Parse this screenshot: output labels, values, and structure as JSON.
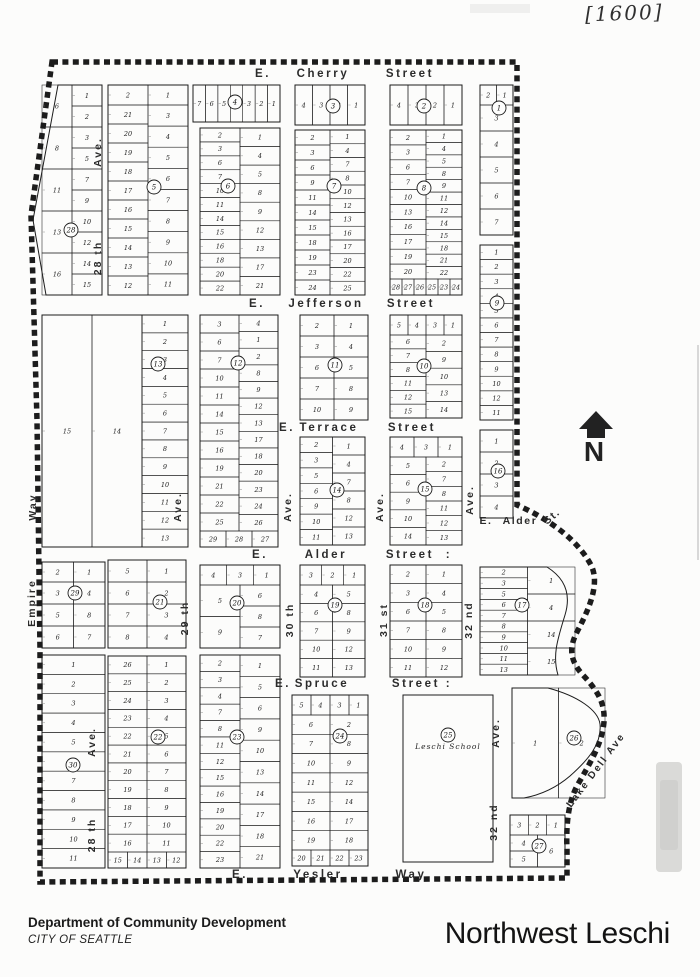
{
  "page": {
    "annotation": "[1600]",
    "title": "Northwest Leschi",
    "footer_line1": "Department of Community Development",
    "footer_line2": "CITY OF SEATTLE"
  },
  "map": {
    "north_label": "N",
    "streets": [
      {
        "name": "E. Cherry Street",
        "y": 77,
        "parts": [
          {
            "t": "E.",
            "x": 263
          },
          {
            "t": "Cherry",
            "x": 323
          },
          {
            "t": "Street",
            "x": 410
          }
        ]
      },
      {
        "name": "E. Jefferson Street",
        "y": 307,
        "parts": [
          {
            "t": "E.",
            "x": 257
          },
          {
            "t": "Jefferson",
            "x": 326
          },
          {
            "t": "Street",
            "x": 411
          }
        ]
      },
      {
        "name": "E. Terrace Street",
        "y": 431,
        "parts": [
          {
            "t": "E.",
            "x": 287
          },
          {
            "t": "Terrace",
            "x": 329
          },
          {
            "t": "Street",
            "x": 412
          }
        ]
      },
      {
        "name": "E. Alder Street",
        "y": 558,
        "parts": [
          {
            "t": "E.",
            "x": 260
          },
          {
            "t": "Alder",
            "x": 326
          },
          {
            "t": "Street",
            "x": 410
          },
          {
            "t": ":",
            "x": 449
          }
        ]
      },
      {
        "name": "E. Spruce Street",
        "y": 687,
        "parts": [
          {
            "t": "E.",
            "x": 283
          },
          {
            "t": "Spruce",
            "x": 322
          },
          {
            "t": "Street",
            "x": 416
          },
          {
            "t": ":",
            "x": 449
          }
        ]
      },
      {
        "name": "E. Yesler Way",
        "y": 878,
        "parts": [
          {
            "t": "E.",
            "x": 240
          },
          {
            "t": "Yesler",
            "x": 318
          },
          {
            "t": "Way",
            "x": 411
          }
        ]
      }
    ],
    "avenues": [
      {
        "t": "Ave.",
        "x": 101,
        "y": 152
      },
      {
        "t": "28 th",
        "x": 101,
        "y": 258
      },
      {
        "t": "Way",
        "x": 36,
        "y": 507
      },
      {
        "t": "Empire",
        "x": 35,
        "y": 603
      },
      {
        "t": "Ave.",
        "x": 181,
        "y": 507
      },
      {
        "t": "29 th",
        "x": 188,
        "y": 618
      },
      {
        "t": "Ave.",
        "x": 291,
        "y": 507
      },
      {
        "t": "30 th",
        "x": 293,
        "y": 620
      },
      {
        "t": "Ave.",
        "x": 383,
        "y": 507
      },
      {
        "t": "31 st",
        "x": 387,
        "y": 620
      },
      {
        "t": "Ave.",
        "x": 473,
        "y": 500
      },
      {
        "t": "32 nd",
        "x": 472,
        "y": 620
      },
      {
        "t": "Ave.",
        "x": 499,
        "y": 733
      },
      {
        "t": "32 nd",
        "x": 497,
        "y": 822
      },
      {
        "t": "Ave.",
        "x": 95,
        "y": 742
      },
      {
        "t": "28 th",
        "x": 95,
        "y": 835
      }
    ],
    "labels": {
      "alder_st": [
        {
          "t": "E.",
          "x": 486,
          "y": 524,
          "r": 0
        },
        {
          "t": "Alder",
          "x": 520,
          "y": 524,
          "r": 0
        },
        {
          "t": "St.",
          "x": 554,
          "y": 519,
          "r": -40
        }
      ],
      "lake": {
        "t": "Lake  Dell  Ave",
        "x": 571,
        "y": 808,
        "r": -53
      },
      "school": "Leschi School"
    },
    "blocks": [
      {
        "n": "1",
        "x": 480,
        "y": 85,
        "w": 33,
        "h": 150,
        "c": [
          499,
          108
        ],
        "t": [
          "2",
          "1"
        ],
        "cols": [
          [
            "3",
            "4",
            "5",
            "6",
            "7"
          ]
        ]
      },
      {
        "n": "2",
        "x": 390,
        "y": 85,
        "w": 72,
        "h": 40,
        "c": [
          424,
          106
        ],
        "t": [
          "4",
          "3",
          "2",
          "1"
        ]
      },
      {
        "n": "3",
        "x": 295,
        "y": 85,
        "w": 70,
        "h": 40,
        "c": [
          333,
          106
        ],
        "t": [
          "4",
          "3",
          "2",
          "1"
        ]
      },
      {
        "n": "4",
        "x": 193,
        "y": 85,
        "w": 87,
        "h": 37,
        "c": [
          235,
          102
        ],
        "t": [
          "7",
          "6",
          "5",
          "4",
          "3",
          "2",
          "1"
        ]
      },
      {
        "n": "5",
        "x": 108,
        "y": 85,
        "w": 80,
        "h": 210,
        "c": [
          154,
          187
        ],
        "t": [
          "2",
          "1"
        ],
        "cols": [
          [
            "21",
            "20",
            "19",
            "18",
            "17",
            "16",
            "15",
            "14",
            "13",
            "12"
          ],
          [
            "3",
            "4",
            "5",
            "6",
            "7",
            "8",
            "9",
            "10",
            "11"
          ]
        ]
      },
      {
        "n": "6",
        "x": 200,
        "y": 128,
        "w": 80,
        "h": 167,
        "c": [
          228,
          186
        ],
        "cols": [
          [
            "2",
            "3",
            "6",
            "7",
            "10",
            "11",
            "14",
            "15",
            "16",
            "18",
            "20",
            "22"
          ],
          [
            "1",
            "4",
            "5",
            "8",
            "9",
            "12",
            "13",
            "17",
            "21"
          ]
        ]
      },
      {
        "n": "7",
        "x": 295,
        "y": 130,
        "w": 70,
        "h": 165,
        "c": [
          334,
          186
        ],
        "cols": [
          [
            "2",
            "3",
            "6",
            "9",
            "11",
            "14",
            "15",
            "18",
            "19",
            "23",
            "24"
          ],
          [
            "1",
            "4",
            "7",
            "8",
            "10",
            "12",
            "13",
            "16",
            "17",
            "20",
            "22",
            "25"
          ]
        ]
      },
      {
        "n": "8",
        "x": 390,
        "y": 130,
        "w": 72,
        "h": 165,
        "c": [
          424,
          188
        ],
        "cols": [
          [
            "2",
            "3",
            "6",
            "7",
            "10",
            "13",
            "16",
            "17",
            "19",
            "20"
          ],
          [
            "1",
            "4",
            "5",
            "8",
            "9",
            "11",
            "12",
            "14",
            "15",
            "18",
            "21",
            "22"
          ]
        ],
        "b": [
          "28",
          "27",
          "26",
          "25",
          "23",
          "24"
        ]
      },
      {
        "n": "9",
        "x": 480,
        "y": 245,
        "w": 33,
        "h": 175,
        "c": [
          497,
          303
        ],
        "cols": [
          [
            "1",
            "2",
            "3",
            "4",
            "5",
            "6",
            "7",
            "8",
            "9",
            "10",
            "12",
            "11"
          ]
        ]
      },
      {
        "n": "10",
        "x": 390,
        "y": 315,
        "w": 72,
        "h": 103,
        "c": [
          424,
          366
        ],
        "t": [
          "5",
          "4",
          "3",
          "1"
        ],
        "cols": [
          [
            "6",
            "7",
            "8",
            "11",
            "12",
            "15"
          ],
          [
            "2",
            "9",
            "10",
            "13",
            "14"
          ]
        ]
      },
      {
        "n": "11",
        "x": 300,
        "y": 315,
        "w": 68,
        "h": 105,
        "c": [
          335,
          365
        ],
        "cols": [
          [
            "2",
            "3",
            "6",
            "7",
            "10"
          ],
          [
            "1",
            "4",
            "5",
            "8",
            "9"
          ]
        ]
      },
      {
        "n": "12",
        "x": 200,
        "y": 315,
        "w": 78,
        "h": 232,
        "c": [
          238,
          363
        ],
        "cols": [
          [
            "3",
            "6",
            "7",
            "10",
            "11",
            "14",
            "15",
            "16",
            "19",
            "21",
            "22",
            "25"
          ],
          [
            "4",
            "1",
            "2",
            "8",
            "9",
            "12",
            "13",
            "17",
            "18",
            "20",
            "23",
            "24",
            "26"
          ]
        ],
        "b": [
          "29",
          "28",
          "27"
        ]
      },
      {
        "n": "13",
        "x": 142,
        "y": 315,
        "w": 46,
        "h": 232,
        "c": [
          158,
          364
        ],
        "cols": [
          [
            "1",
            "2",
            "3",
            "4",
            "5",
            "6",
            "7",
            "8",
            "9",
            "10",
            "11",
            "12",
            "13"
          ]
        ]
      },
      {
        "n": "",
        "x": 42,
        "y": 315,
        "w": 100,
        "h": 232,
        "cols": [
          [
            "15"
          ],
          [
            "14"
          ]
        ]
      },
      {
        "n": "14",
        "x": 300,
        "y": 437,
        "w": 65,
        "h": 108,
        "c": [
          337,
          490
        ],
        "cols": [
          [
            "2",
            "3",
            "5",
            "6",
            "9",
            "10",
            "11"
          ],
          [
            "1",
            "4",
            "7",
            "8",
            "12",
            "13"
          ]
        ]
      },
      {
        "n": "15",
        "x": 390,
        "y": 437,
        "w": 72,
        "h": 108,
        "c": [
          425,
          489
        ],
        "t": [
          "4",
          "3",
          "1"
        ],
        "cols": [
          [
            "5",
            "6",
            "9",
            "10",
            "14"
          ],
          [
            "2",
            "7",
            "8",
            "11",
            "12",
            "13"
          ]
        ]
      },
      {
        "n": "16",
        "x": 480,
        "y": 430,
        "w": 33,
        "h": 88,
        "c": [
          498,
          471
        ],
        "cols": [
          [
            "1",
            "2",
            "3",
            "4"
          ]
        ]
      },
      {
        "n": "17",
        "x": 480,
        "y": 567,
        "w": 95,
        "h": 108,
        "c": [
          522,
          605
        ],
        "cols": [
          [
            "2",
            "3",
            "5",
            "6",
            "7",
            "8",
            "9",
            "10",
            "11",
            "13"
          ],
          [
            "1",
            "4",
            "14",
            "15"
          ]
        ],
        "curve": "e17"
      },
      {
        "n": "18",
        "x": 390,
        "y": 565,
        "w": 72,
        "h": 112,
        "c": [
          425,
          605
        ],
        "cols": [
          [
            "2",
            "3",
            "6",
            "7",
            "10",
            "11"
          ],
          [
            "1",
            "4",
            "5",
            "8",
            "9",
            "12"
          ]
        ]
      },
      {
        "n": "19",
        "x": 300,
        "y": 565,
        "w": 65,
        "h": 112,
        "c": [
          335,
          605
        ],
        "t": [
          "3",
          "2",
          "1"
        ],
        "cols": [
          [
            "4",
            "6",
            "7",
            "10",
            "11"
          ],
          [
            "5",
            "8",
            "9",
            "12",
            "13"
          ]
        ]
      },
      {
        "n": "20",
        "x": 200,
        "y": 565,
        "w": 80,
        "h": 83,
        "c": [
          237,
          603
        ],
        "t": [
          "4",
          "3",
          "1"
        ],
        "cols": [
          [
            "5",
            "9"
          ],
          [
            "6",
            "8",
            "7"
          ]
        ]
      },
      {
        "n": "21",
        "x": 108,
        "y": 560,
        "w": 78,
        "h": 88,
        "c": [
          160,
          602
        ],
        "cols": [
          [
            "5",
            "6",
            "7",
            "8"
          ],
          [
            "1",
            "2",
            "3",
            "4"
          ]
        ]
      },
      {
        "n": "22",
        "x": 108,
        "y": 656,
        "w": 78,
        "h": 212,
        "c": [
          158,
          737
        ],
        "cols": [
          [
            "26",
            "25",
            "24",
            "23",
            "22",
            "21",
            "20",
            "19",
            "18",
            "17",
            "16"
          ],
          [
            "1",
            "2",
            "3",
            "4",
            "5",
            "6",
            "7",
            "8",
            "9",
            "10",
            "11"
          ]
        ],
        "b": [
          "15",
          "14",
          "13",
          "12"
        ]
      },
      {
        "n": "23",
        "x": 200,
        "y": 655,
        "w": 80,
        "h": 213,
        "c": [
          237,
          737
        ],
        "cols": [
          [
            "2",
            "3",
            "4",
            "7",
            "8",
            "11",
            "12",
            "15",
            "16",
            "19",
            "20",
            "22",
            "23"
          ],
          [
            "1",
            "5",
            "6",
            "9",
            "10",
            "13",
            "14",
            "17",
            "18",
            "21"
          ]
        ]
      },
      {
        "n": "24",
        "x": 292,
        "y": 695,
        "w": 76,
        "h": 171,
        "c": [
          340,
          736
        ],
        "t": [
          "5",
          "4",
          "3",
          "1"
        ],
        "cols": [
          [
            "6",
            "7",
            "10",
            "11",
            "15",
            "16",
            "19"
          ],
          [
            "2",
            "8",
            "9",
            "12",
            "14",
            "17",
            "18"
          ]
        ],
        "b": [
          "20",
          "21",
          "22",
          "23"
        ]
      },
      {
        "n": "25",
        "x": 403,
        "y": 695,
        "w": 90,
        "h": 167,
        "c": [
          448,
          735
        ],
        "school": true
      },
      {
        "n": "26",
        "x": 512,
        "y": 688,
        "w": 93,
        "h": 110,
        "c": [
          574,
          738
        ],
        "cols": [
          [
            "1"
          ],
          [
            "2"
          ]
        ],
        "curve": "e26"
      },
      {
        "n": "27",
        "x": 510,
        "y": 815,
        "w": 55,
        "h": 52,
        "c": [
          539,
          846
        ],
        "t": [
          "3",
          "2",
          "1"
        ],
        "cols": [
          [
            "4",
            "5"
          ],
          [
            "6"
          ]
        ]
      },
      {
        "n": "28",
        "x": 42,
        "y": 85,
        "w": 60,
        "h": 210,
        "c": [
          71,
          230
        ],
        "cols": [
          [
            "6",
            "8",
            "11",
            "13",
            "16"
          ],
          [
            "1",
            "2",
            "3",
            "5",
            "7",
            "9",
            "10",
            "12",
            "14",
            "15"
          ]
        ],
        "slant": true
      },
      {
        "n": "29",
        "x": 42,
        "y": 562,
        "w": 63,
        "h": 86,
        "c": [
          75,
          593
        ],
        "t": [
          "2",
          "1"
        ],
        "cols": [
          [
            "3",
            "5",
            "6"
          ],
          [
            "4",
            "8",
            "7"
          ]
        ]
      },
      {
        "n": "30",
        "x": 42,
        "y": 655,
        "w": 63,
        "h": 213,
        "c": [
          73,
          765
        ],
        "cols": [
          [
            "1",
            "2",
            "3",
            "4",
            "5",
            "6",
            "7",
            "8",
            "9",
            "10",
            "11"
          ]
        ]
      }
    ]
  }
}
